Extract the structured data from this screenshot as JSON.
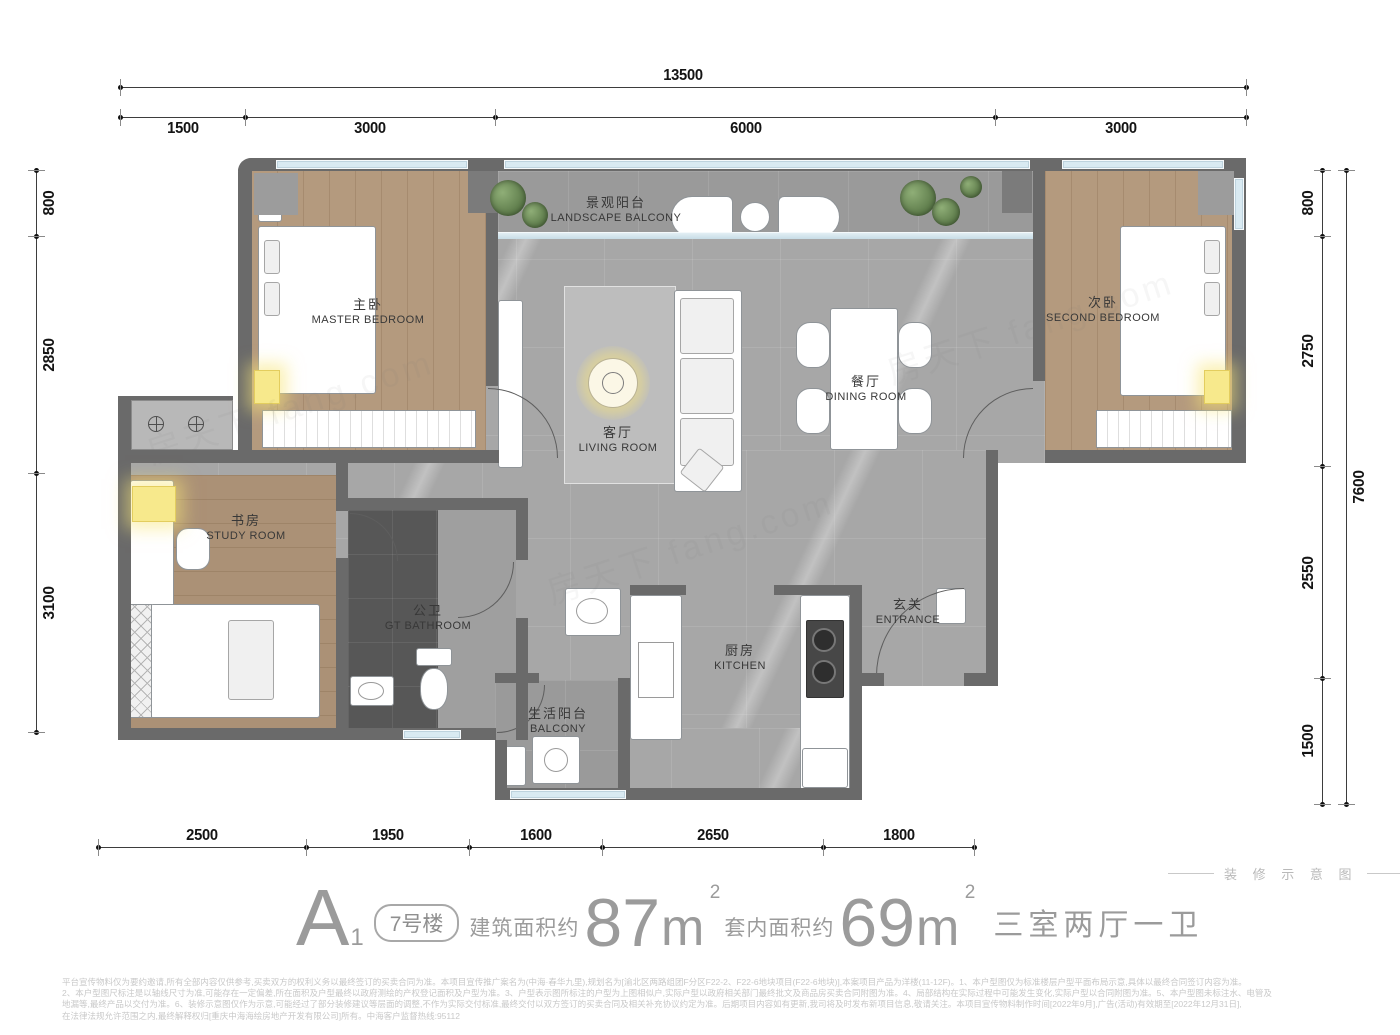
{
  "title": {
    "type_name": "A",
    "type_sub": "1",
    "building_badge": "7号楼",
    "gross_area_label": "建筑面积约",
    "gross_area_value": "87",
    "net_area_label": "套内面积约",
    "net_area_value": "69",
    "area_unit": "m",
    "area_sup": "2",
    "layout_text": "三室两厅一卫"
  },
  "decor_note": "装 修 示 意 图",
  "watermark": "房天下 fang.com",
  "dimensions": {
    "top_total": "13500",
    "top_segments": [
      "1500",
      "3000",
      "6000",
      "3000"
    ],
    "left_segments": [
      "800",
      "2850",
      "3100"
    ],
    "right_segments": [
      "800",
      "2750",
      "2550",
      "1500"
    ],
    "right_total": "7600",
    "bottom_segments": [
      "2500",
      "1950",
      "1600",
      "2650",
      "1800"
    ]
  },
  "rooms": [
    {
      "id": "landscape_balcony",
      "cn": "景观阳台",
      "en": "LANDSCAPE BALCONY"
    },
    {
      "id": "master_bedroom",
      "cn": "主卧",
      "en": "MASTER BEDROOM"
    },
    {
      "id": "second_bedroom",
      "cn": "次卧",
      "en": "SECOND BEDROOM"
    },
    {
      "id": "living_room",
      "cn": "客厅",
      "en": "LIVING ROOM"
    },
    {
      "id": "dining_room",
      "cn": "餐厅",
      "en": "DINING ROOM"
    },
    {
      "id": "study_room",
      "cn": "书房",
      "en": "STUDY ROOM"
    },
    {
      "id": "gt_bathroom",
      "cn": "公卫",
      "en": "GT BATHROOM"
    },
    {
      "id": "kitchen",
      "cn": "厨房",
      "en": "KITCHEN"
    },
    {
      "id": "entrance",
      "cn": "玄关",
      "en": "ENTRANCE"
    },
    {
      "id": "life_balcony",
      "cn": "生活阳台",
      "en": "BALCONY"
    }
  ],
  "disclaimer_lines": [
    "平台宣传物料仅为要约邀请,所有全部内容仅供参考,买卖双方的权利义务以最终签订的买卖合同为准。本项目宣传推广案名为(中海·春华九里),规划名为[渝北区两路组团F分区F22-2、F22-6地块项目(F22-6地块)],本案项目产品为洋楼(11-12F)。1、本户型图仅为标准楼层户型平面布局示意,具体以最终合同签订内容为准。",
    "2、本户型图尺标注是以轴线尺寸为准,可能存在一定偏差,所在面积及户型最终以政府测绘的产权登记面积及户型为准。3、户型表示图所标注的户型为上图相似户,实际户型以政府相关部门最终批文及商品房买卖合同附图为准。4、局部结构在实际过程中可能发生变化,实际户型以合同附图为准。5、本户型图未标注水、电管及",
    "地漏等,最终产品以交付为准。6、装修示意图仅作为示意,可能经过了部分装修建议等层面的调整,不作为实际交付标准,最终交付以双方签订的买卖合同及相关补充协议约定为准。后期项目内容如有更新,我司将及时发布新项目信息,敬请关注。本项目宣传物料制作时间[2022年9月],广告(活动)有效期至[2022年12月31日],",
    "在法律法规允许范围之内,最终解释权归[重庆中海海绘房地产开发有限公司]所有。中海客户监督热线:95112"
  ],
  "colors": {
    "wall": "#6a6a6a",
    "marble_floor": "#a7a7a7",
    "wood_floor": "#b49a7e",
    "dark_tile": "#575757",
    "window_blue": "#d9eaf2",
    "accent_yellow": "#f7e98c",
    "plant_green": "#6f8f5f",
    "dim_text": "#141414",
    "title_gray": "#9b9b9b"
  }
}
